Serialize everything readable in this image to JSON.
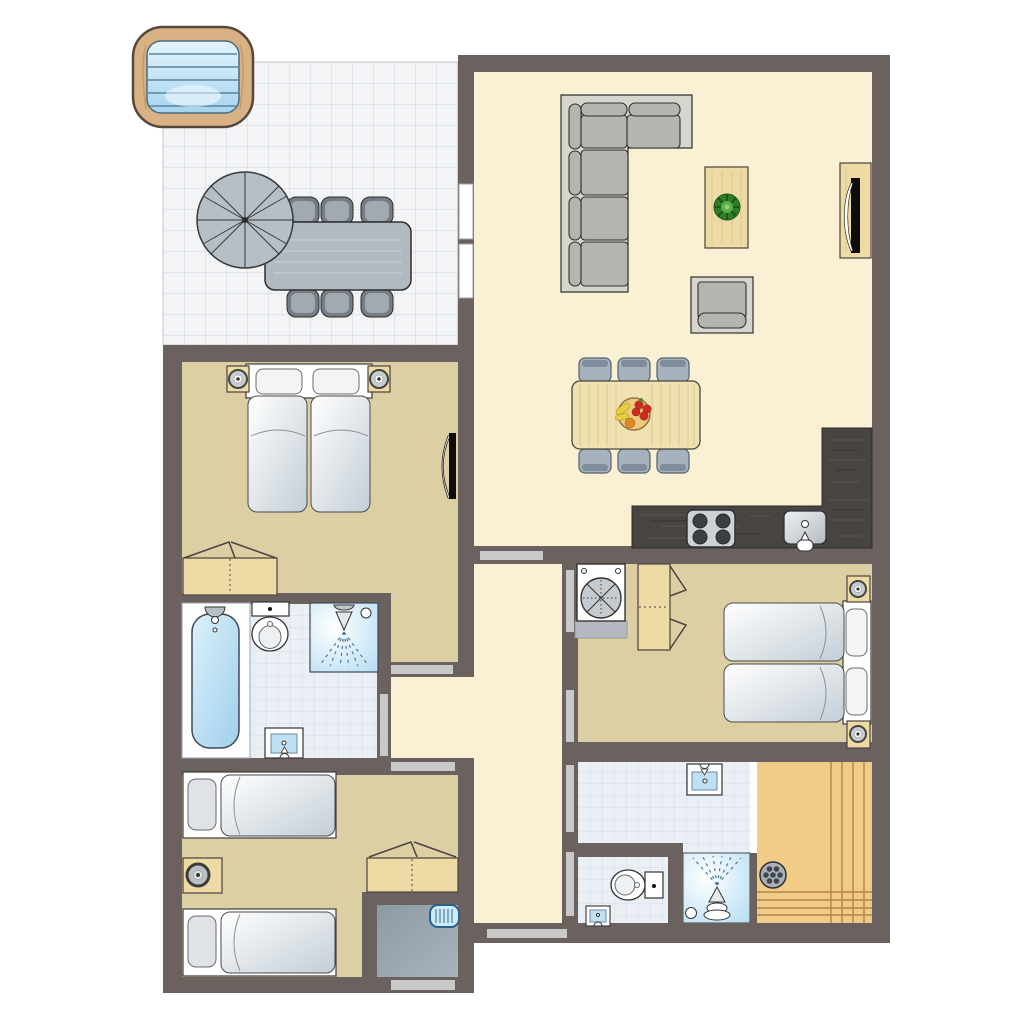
{
  "document": {
    "kind": "apartment floor plan drawing",
    "visible_text": "none",
    "orientation": "top-down plan view"
  },
  "palette": {
    "wall": "#6b6260",
    "cream": "#faf0d3",
    "beige": "#dccfa4",
    "tile": "#ebf0f6",
    "tile_line": "#d7dee8",
    "terrace": "#f3f4f6",
    "terrace_line": "#cfd4db",
    "door": "#c9c9c9",
    "wood": "#eddaa5",
    "wood_dark": "#4a443c",
    "counter": "#474442",
    "sofa_base": "#d6d6ce",
    "sofa_cushion": "#b5b5af",
    "sauna": "#f0cc86",
    "sauna_line": "#b5854a",
    "storage": "#97a4ae",
    "water_light": "#ddf1fb",
    "water_deep": "#9fcfec",
    "radiator": "#cdeaf8",
    "plant_green": "#2e7d27",
    "fruit_red": "#cf2b20",
    "fruit_yellow": "#e9ce3c",
    "fruit_orange": "#e08728"
  },
  "plan": {
    "rooms": [
      {
        "id": "terrace",
        "floor": "white tile grid",
        "furniture": [
          "hot-tub",
          "parasol",
          "outdoor-dining-table",
          "6 outdoor-chairs"
        ]
      },
      {
        "id": "living-room",
        "floor": "cream",
        "furniture": [
          "corner-sofa",
          "coffee-table with plant",
          "armchair",
          "tv-cabinet",
          "dining-table with fruit-bowl",
          "6 dining-chairs",
          "kitchen-counter",
          "stove 4 burners",
          "kitchen-sink"
        ]
      },
      {
        "id": "bedroom-1",
        "floor": "beige",
        "furniture": [
          "double-bed",
          "2 nightstands with lamps",
          "wardrobe",
          "door-leaf"
        ]
      },
      {
        "id": "bathroom-1",
        "floor": "light tile",
        "furniture": [
          "bathtub",
          "toilet",
          "shower",
          "washbasin"
        ]
      },
      {
        "id": "bedroom-2",
        "floor": "beige",
        "furniture": [
          "2 single-beds",
          "nightstand with lamp",
          "wardrobe"
        ]
      },
      {
        "id": "storage-room",
        "floor": "gray",
        "furniture": [
          "heater-radiator"
        ]
      },
      {
        "id": "bedroom-3",
        "floor": "beige",
        "furniture": [
          "washing-machine",
          "wardrobe",
          "double-bed",
          "2 nightstands with lamps"
        ]
      },
      {
        "id": "bathroom-2",
        "floor": "light tile",
        "furniture": [
          "washbasin",
          "shower",
          "sauna with stove"
        ]
      },
      {
        "id": "toilet-room",
        "floor": "light tile",
        "furniture": [
          "toilet",
          "small-washbasin"
        ]
      },
      {
        "id": "hallway",
        "floor": "cream",
        "furniture": []
      }
    ],
    "door_openings_count": 10,
    "window_panels_count": 2
  }
}
